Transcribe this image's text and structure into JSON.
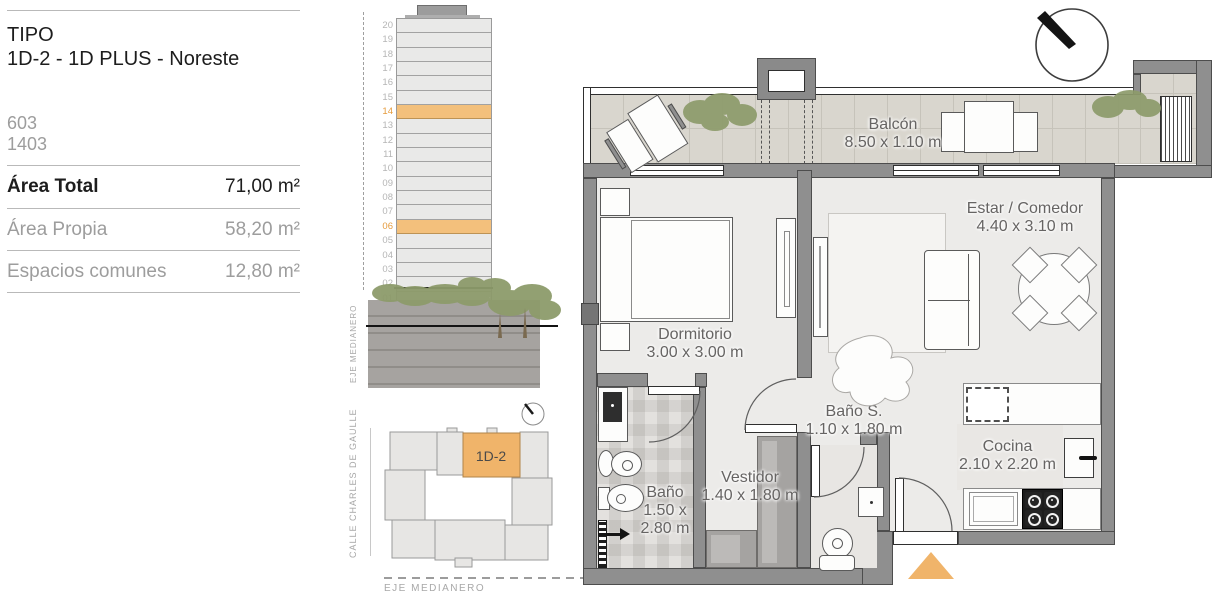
{
  "info_panel": {
    "tipo_label": "TIPO",
    "tipo_value": "1D-2 - 1D PLUS - Noreste",
    "units": [
      "603",
      "1403"
    ],
    "rows": [
      {
        "label": "Área Total",
        "value": "71,00 m²"
      },
      {
        "label": "Área Propia",
        "value": "58,20 m²"
      },
      {
        "label": "Espacios comunes",
        "value": "12,80 m²"
      }
    ]
  },
  "elevation": {
    "axis_label": "EJE MEDIANERO",
    "floors": [
      "20",
      "19",
      "18",
      "17",
      "16",
      "15",
      "14",
      "13",
      "12",
      "11",
      "10",
      "09",
      "08",
      "07",
      "06",
      "05",
      "04",
      "03",
      "02",
      "01"
    ],
    "highlighted_floors": [
      "14",
      "06"
    ]
  },
  "site_plan": {
    "street_label": "CALLE CHARLES DE GAULLE",
    "axis_label": "EJE MEDIANERO",
    "unit_label": "1D-2"
  },
  "floor_plan": {
    "rooms": {
      "balcon": {
        "name": "Balcón",
        "dims": "8.50 x 1.10 m"
      },
      "dormitorio": {
        "name": "Dormitorio",
        "dims": "3.00 x 3.00 m"
      },
      "estar": {
        "name": "Estar / Comedor",
        "dims": "4.40 x 3.10 m"
      },
      "bano_s": {
        "name": "Baño S.",
        "dims": "1.10 x 1.80 m"
      },
      "bano": {
        "name": "Baño",
        "dims1": "1.50 x",
        "dims2": "2.80 m"
      },
      "vestidor": {
        "name": "Vestidor",
        "dims": "1.40 x 1.80 m"
      },
      "cocina": {
        "name": "Cocina",
        "dims": "2.10 x 2.20 m"
      }
    }
  },
  "colors": {
    "accent_orange": "#f0b46a",
    "wall_gray": "#8f8f8f",
    "plant_green": "#8d9b6b"
  }
}
